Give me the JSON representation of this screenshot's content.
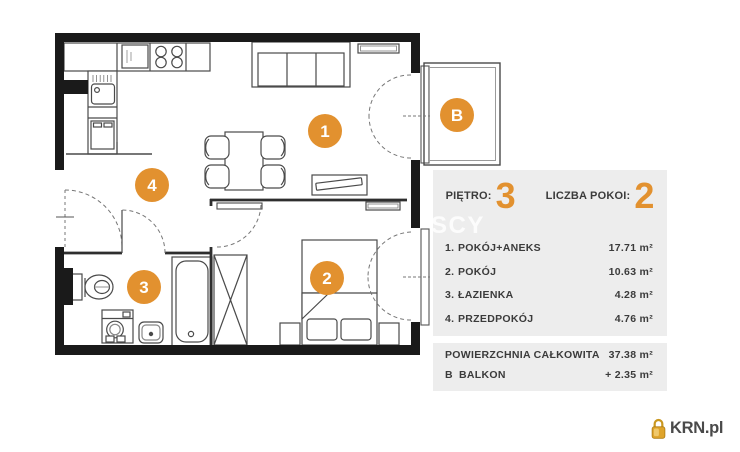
{
  "floor_plan": {
    "badges": [
      {
        "id": "room-1",
        "label": "1"
      },
      {
        "id": "room-2",
        "label": "2"
      },
      {
        "id": "room-3",
        "label": "3"
      },
      {
        "id": "room-4",
        "label": "4"
      },
      {
        "id": "balcony",
        "label": "B"
      }
    ]
  },
  "panel": {
    "floor_label": "PIĘTRO:",
    "floor_value": "3",
    "rooms_count_label": "LICZBA POKOI:",
    "rooms_count_value": "2",
    "rooms": [
      {
        "no": "1.",
        "name": "POKÓJ+ANEKS",
        "area": "17.71 m²"
      },
      {
        "no": "2.",
        "name": "POKÓJ",
        "area": "10.63 m²"
      },
      {
        "no": "3.",
        "name": "ŁAZIENKA",
        "area": "4.28 m²"
      },
      {
        "no": "4.",
        "name": "PRZEDPOKÓJ",
        "area": "4.76 m²"
      }
    ],
    "summary": {
      "total_label": "POWIERZCHNIA CAŁKOWITA",
      "total_area": "37.38 m²",
      "balcony_no": "B",
      "balcony_label": "BALKON",
      "balcony_area": "+ 2.35 m²"
    }
  },
  "watermark": "SCY",
  "logo": {
    "text": "KRN.pl"
  },
  "colors": {
    "accent": "#E2912F",
    "panel_bg": "#EDEDED",
    "text": "#3B3B3B",
    "wall": "#1A1A1A"
  }
}
